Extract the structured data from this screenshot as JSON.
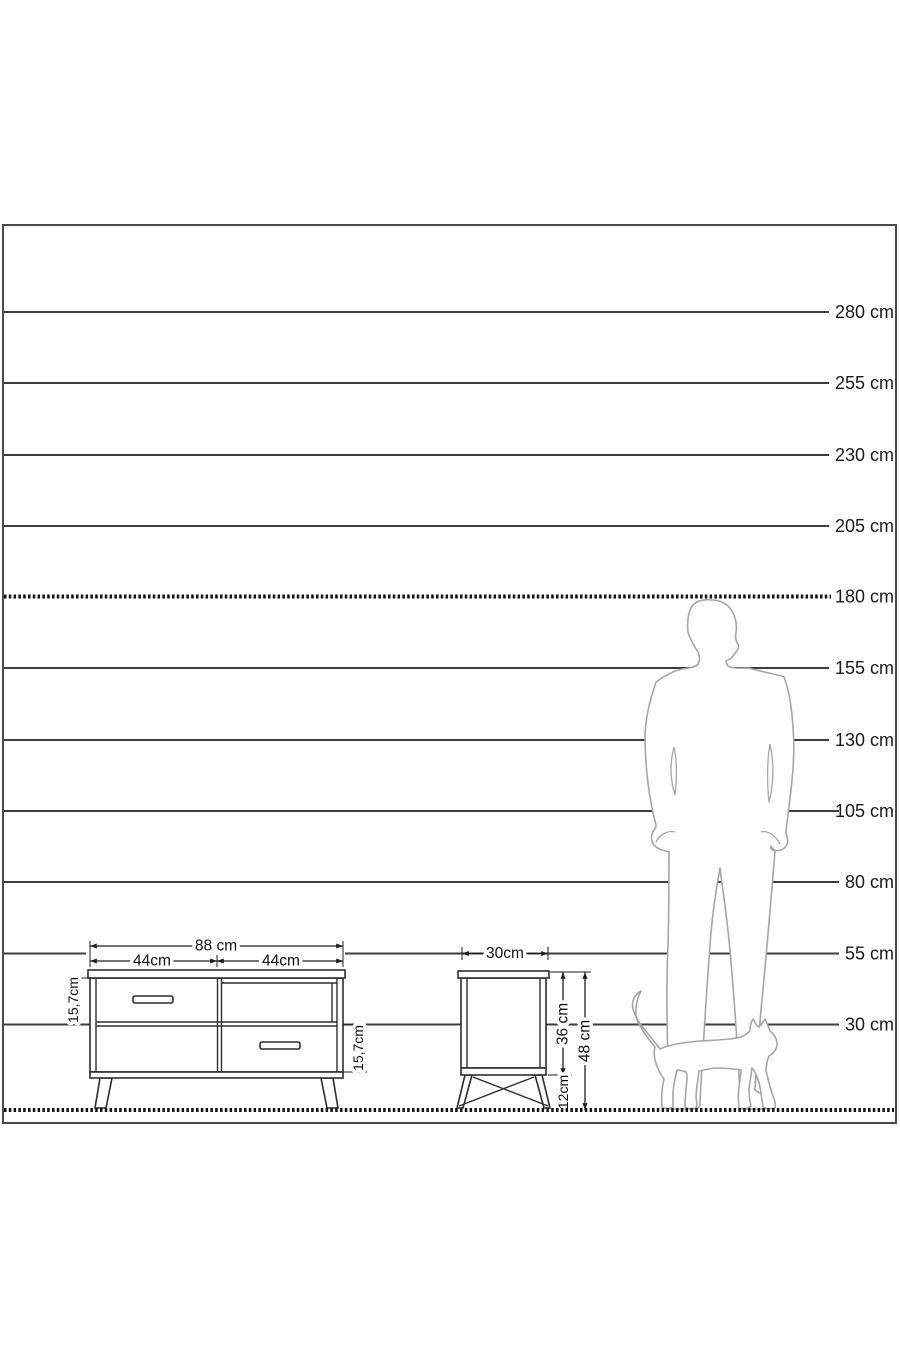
{
  "diagram": {
    "type": "furniture-size-comparison-diagram",
    "unit": "cm",
    "colors": {
      "scale_line": "#3d3d3d",
      "dotted_line": "#121212",
      "text": "#1a1a1a",
      "furniture_stroke": "#2e2e2e",
      "silhouette_stroke": "#a6a6a6",
      "background": "#ffffff"
    }
  },
  "scale": {
    "labels": [
      {
        "text": "280 cm",
        "cm": 280
      },
      {
        "text": "255 cm",
        "cm": 255
      },
      {
        "text": "230 cm",
        "cm": 230
      },
      {
        "text": "205 cm",
        "cm": 205
      },
      {
        "text": "180 cm",
        "cm": 180
      },
      {
        "text": "155 cm",
        "cm": 155
      },
      {
        "text": "130 cm",
        "cm": 130
      },
      {
        "text": "105 cm",
        "cm": 105
      },
      {
        "text": "80 cm",
        "cm": 80
      },
      {
        "text": "55 cm",
        "cm": 55
      },
      {
        "text": "30 cm",
        "cm": 30
      }
    ]
  },
  "tv_stand": {
    "overall_width": "88 cm",
    "left_section_width": "44cm",
    "right_section_width": "44cm",
    "top_drawer_height": "15,7cm",
    "bottom_drawer_height": "15,7cm"
  },
  "nightstand": {
    "width": "30cm",
    "body_height": "36 cm",
    "total_height": "48 cm",
    "leg_height": "12cm"
  },
  "figures": {
    "man": "man-silhouette",
    "cat": "cat-silhouette"
  }
}
